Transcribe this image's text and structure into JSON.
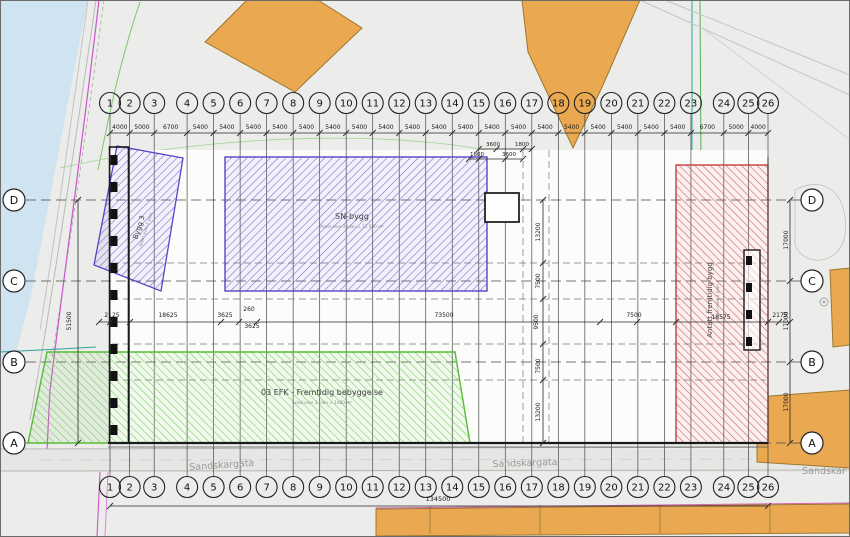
{
  "grid": {
    "numbered_axes": [
      "1",
      "2",
      "3",
      "4",
      "5",
      "6",
      "7",
      "8",
      "9",
      "10",
      "11",
      "12",
      "13",
      "14",
      "15",
      "16",
      "17",
      "18",
      "19",
      "20",
      "21",
      "22",
      "23",
      "24",
      "25",
      "26"
    ],
    "axis_spacings_mm": [
      4000,
      5000,
      6700,
      5400,
      5400,
      5400,
      5400,
      5400,
      5400,
      5400,
      5400,
      5400,
      5400,
      5400,
      5400,
      5400,
      5400,
      5400,
      5400,
      5400,
      5400,
      5400,
      6700,
      5000,
      4000
    ],
    "lettered_axes": [
      "D",
      "C",
      "B",
      "A"
    ],
    "letter_spacings_mm": [
      17000,
      17000,
      17000
    ]
  },
  "dimensions": {
    "middle_row": [
      {
        "text": "2125",
        "x": 112,
        "y": 317
      },
      {
        "text": "18625",
        "x": 168,
        "y": 317
      },
      {
        "text": "3625",
        "x": 225,
        "y": 317
      },
      {
        "text": "260",
        "x": 249,
        "y": 311
      },
      {
        "text": "3625",
        "x": 252,
        "y": 328
      },
      {
        "text": "73500",
        "x": 444,
        "y": 317
      },
      {
        "text": "7500",
        "x": 634,
        "y": 317
      },
      {
        "text": "18575",
        "x": 721,
        "y": 319
      },
      {
        "text": "2175",
        "x": 780,
        "y": 317
      }
    ],
    "center_column": [
      {
        "text": "13200",
        "x": 540,
        "y": 232,
        "rot": -90
      },
      {
        "text": "7500",
        "x": 540,
        "y": 281,
        "rot": -90
      },
      {
        "text": "9500",
        "x": 538,
        "y": 322,
        "rot": -90
      },
      {
        "text": "7500",
        "x": 540,
        "y": 366,
        "rot": -90
      },
      {
        "text": "13200",
        "x": 540,
        "y": 412,
        "rot": -90
      }
    ],
    "secondary_top": [
      {
        "text": "3600",
        "x": 493,
        "y": 146
      },
      {
        "text": "1800",
        "x": 522,
        "y": 146
      },
      {
        "text": "1800",
        "x": 477,
        "y": 156
      },
      {
        "text": "3600",
        "x": 509,
        "y": 156
      }
    ],
    "left_total": {
      "text": "51500",
      "x": 71,
      "y": 321,
      "rot": -90
    },
    "right_column": [
      {
        "text": "17000",
        "x": 788,
        "y": 240,
        "rot": -90
      },
      {
        "text": "17000",
        "x": 788,
        "y": 321,
        "rot": -90
      },
      {
        "text": "17000",
        "x": 788,
        "y": 402,
        "rot": -90
      }
    ],
    "bottom_total": {
      "text": "134500",
      "x": 438,
      "y": 501
    }
  },
  "areas": [
    {
      "id": "bygg3",
      "label": "Bygg 3",
      "sublabel": "Areal over 2 plan",
      "x": 141,
      "y": 228,
      "rot": -72
    },
    {
      "id": "sn-bygg",
      "label": "SN-bygg",
      "sublabel": "Areal over 2 plan = 11 500 m²",
      "x": 352,
      "y": 219,
      "rot": 0
    },
    {
      "id": "efk",
      "label": "03 EFK - Fremtidig bebyggelse",
      "sublabel": "Areal over 2 plan = 1480 m²",
      "x": 322,
      "y": 395,
      "rot": 0
    },
    {
      "id": "fremtidig",
      "label": "Antatt fremtidig bygg",
      "sublabel": "Areal over 2 plan",
      "x": 712,
      "y": 300,
      "rot": -90
    }
  ],
  "streets": [
    {
      "name": "Sandskargata",
      "x": 222,
      "y": 468,
      "rot": -4
    },
    {
      "name": "Sandskargata",
      "x": 525,
      "y": 466,
      "rot": -2
    },
    {
      "name": "Sandskar",
      "x": 824,
      "y": 474,
      "rot": 0
    }
  ],
  "colors": {
    "water": "#cfe4f0",
    "building": "#eaa851",
    "building_stroke": "#9c772f",
    "hatch_purple": "#6a4fd0",
    "hatch_green": "#58c437",
    "hatch_red": "#d24040",
    "grid_line": "#474747",
    "dim_text": "#1a1a1a",
    "street_text": "#9b9b99",
    "magenta": "#cc55cc",
    "teal": "#2fa39a"
  }
}
